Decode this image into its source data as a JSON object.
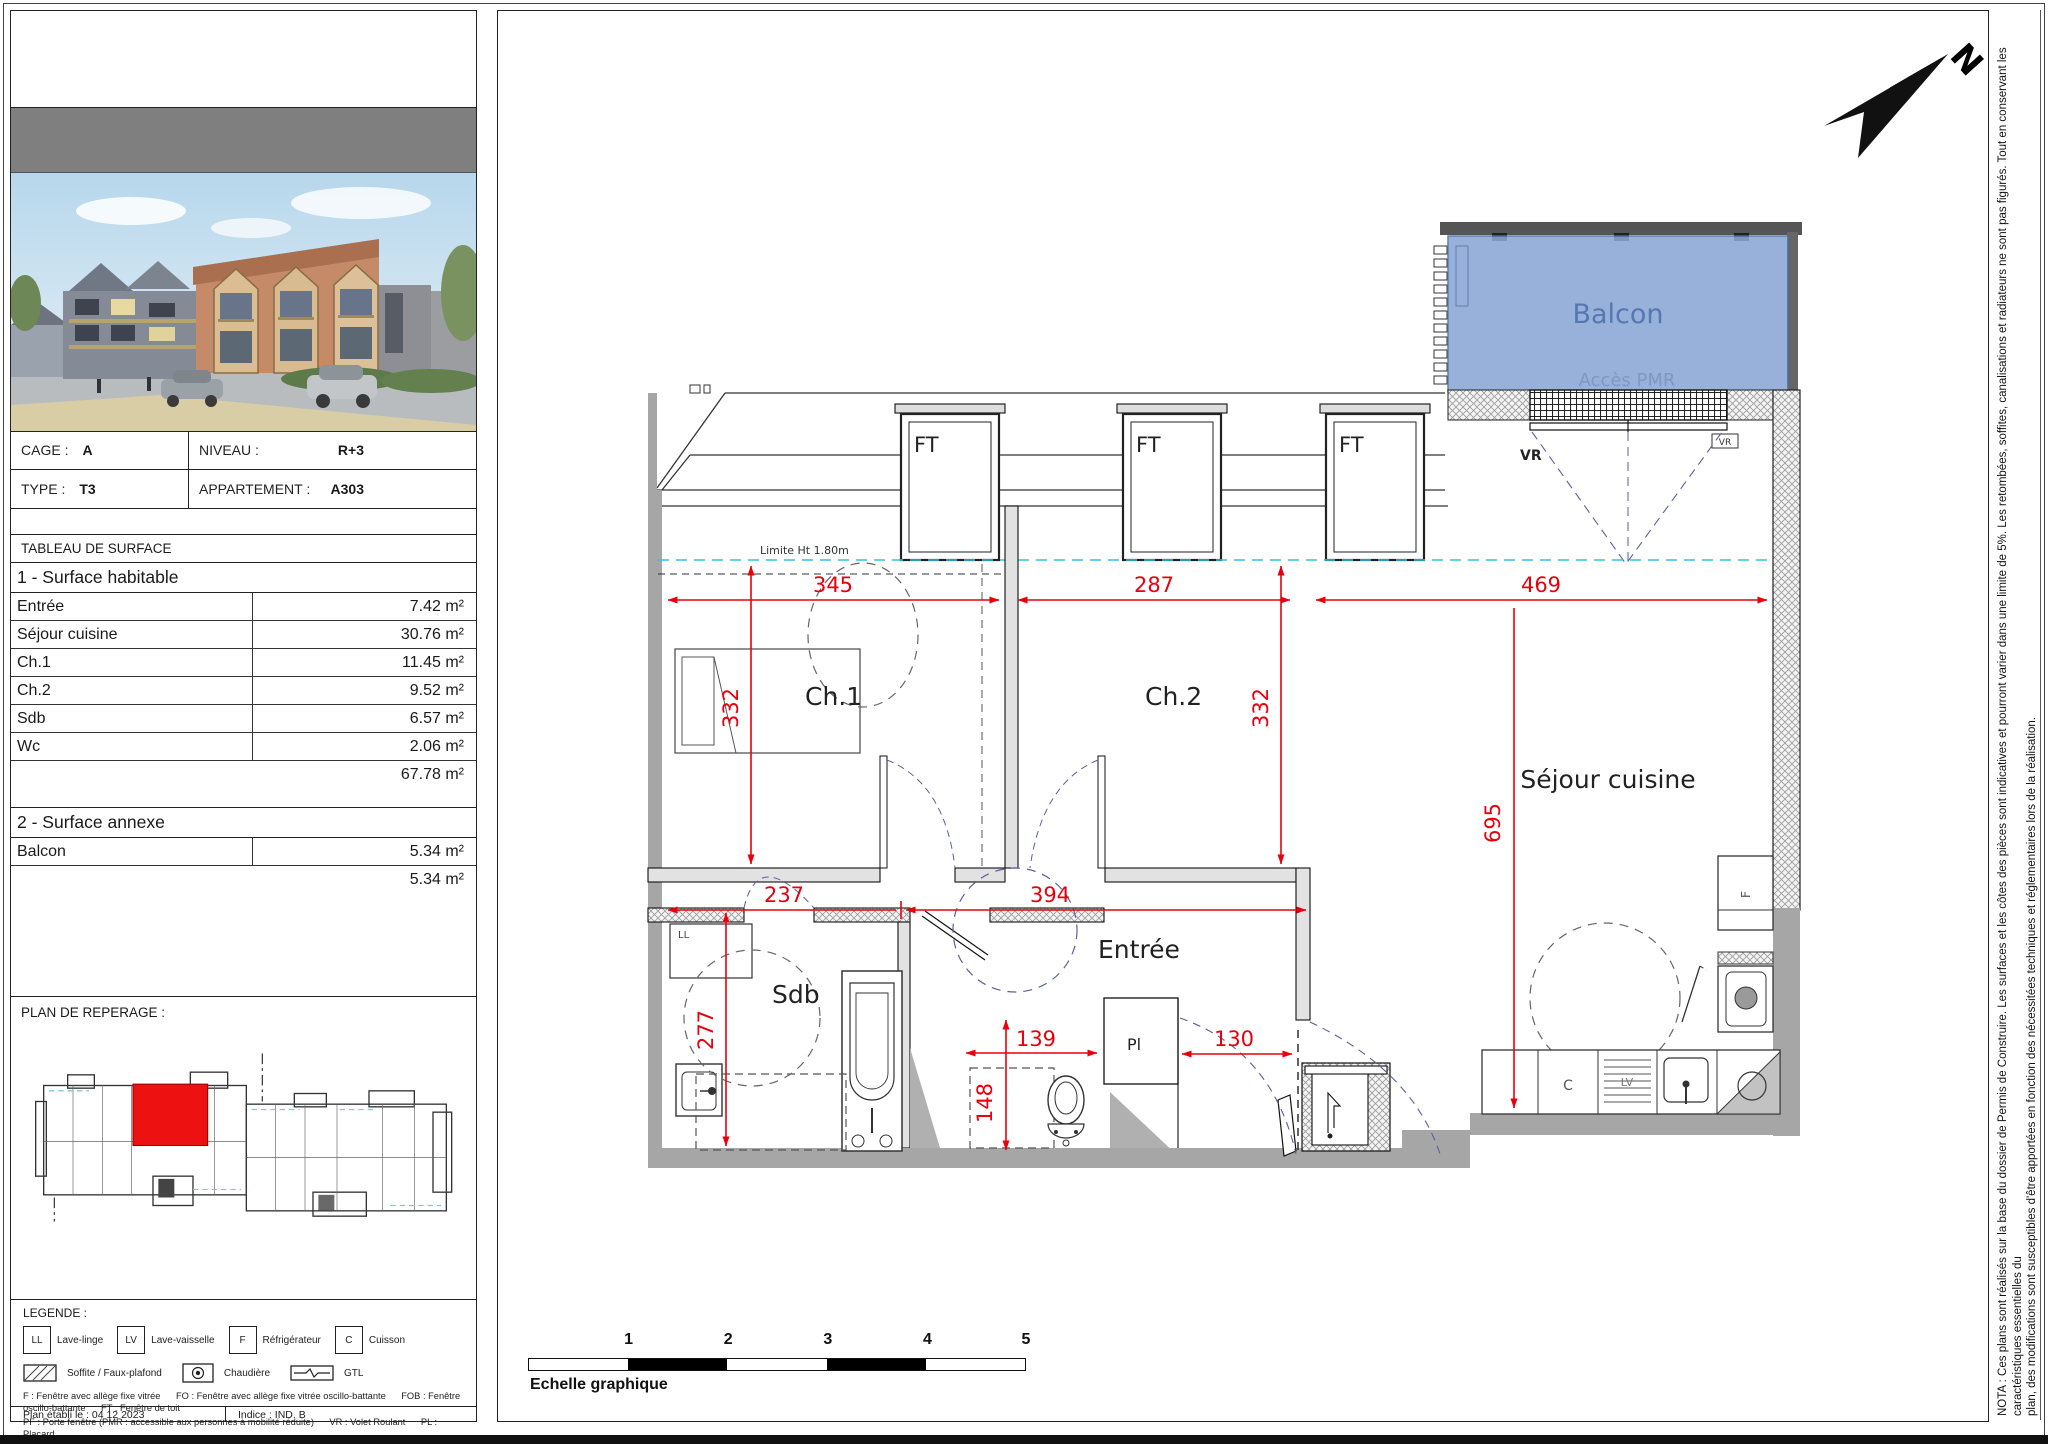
{
  "sidebar": {
    "info": {
      "cage_label": "CAGE :",
      "cage_value": "A",
      "niveau_label": "NIVEAU :",
      "niveau_value": "R+3",
      "type_label": "TYPE :",
      "type_value": "T3",
      "appartement_label": "APPARTEMENT :",
      "appartement_value": "A303"
    },
    "surface_table": {
      "title": "TABLEAU DE SURFACE",
      "section1": "1 - Surface habitable",
      "rows": [
        {
          "label": "Entrée",
          "value": "7.42 m²"
        },
        {
          "label": "Séjour cuisine",
          "value": "30.76 m²"
        },
        {
          "label": "Ch.1",
          "value": "11.45 m²"
        },
        {
          "label": "Ch.2",
          "value": "9.52 m²"
        },
        {
          "label": "Sdb",
          "value": "6.57 m²"
        },
        {
          "label": "Wc",
          "value": "2.06 m²"
        }
      ],
      "section1_total": "67.78 m²",
      "section2": "2 - Surface annexe",
      "annexe_rows": [
        {
          "label": "Balcon",
          "value": "5.34 m²"
        }
      ],
      "section2_total": "5.34 m²"
    },
    "reperage_title": "PLAN DE REPERAGE :",
    "legend": {
      "title": "LEGENDE :",
      "appliances": [
        {
          "code": "LL",
          "label": "Lave-linge"
        },
        {
          "code": "LV",
          "label": "Lave-vaisselle"
        },
        {
          "code": "F",
          "label": "Réfrigérateur"
        },
        {
          "code": "C",
          "label": "Cuisson"
        }
      ],
      "symbols": [
        {
          "label": "Soffite / Faux-plafond"
        },
        {
          "label": "Chaudière"
        },
        {
          "label": "GTL"
        }
      ],
      "abbrev_line1": "F : Fenêtre avec allège fixe vitrée      FO : Fenêtre avec allège fixe vitrée oscillo-battante      FOB : Fenêtre oscillo-battante      FT : Fenêtre de toit",
      "abbrev_line2": "PF : Porte fenêtre (PMR : accessible aux personnes à mobilité réduite)      VR : Volet Roulant      PL : Placard",
      "footer_left": "Plan établi le : 04 12 2023",
      "footer_right": "Indice : IND. B"
    }
  },
  "plan": {
    "north_label": "N",
    "balcon": "Balcon",
    "acces_pmr": "Accès PMR",
    "limite": "Limite Ht 1.80m",
    "rooms": {
      "ch1": "Ch.1",
      "ch2": "Ch.2",
      "sejour": "Séjour cuisine",
      "sdb": "Sdb",
      "entree": "Entrée"
    },
    "labels": {
      "ft": "FT",
      "vr": "VR",
      "ll": "LL",
      "c": "C",
      "lv": "LV",
      "f": "F",
      "pl": "Pl"
    },
    "dims": {
      "ch1_w": "345",
      "ch2_w": "287",
      "sejour_w": "469",
      "ch1_h": "332",
      "ch2_h": "332",
      "sejour_h": "695",
      "sdb_w": "237",
      "hall_w": "394",
      "sdb_h": "277",
      "wc_w": "139",
      "wc_h": "148",
      "entree_w": "130"
    }
  },
  "scale_bar": {
    "numbers": [
      "1",
      "2",
      "3",
      "4",
      "5"
    ],
    "label": "Echelle graphique"
  },
  "nota": {
    "line1": "NOTA : Ces plans sont réalisés sur la base du dossier de Permis de Construire. Les surfaces et les côtes des pièces sont indicatives et pourront varier dans une limite de 5%.  Les retombées, soffites, canalisations et radiateurs ne sont pas figurés. Tout en conservant les caractéristiques essentielles du",
    "line2": "plan, des modifications sont susceptibles d'être apportées en fonction des nécessitées techniques et réglementaires lors de la réalisation."
  },
  "colors": {
    "dimension_red": "#e8000d",
    "balcony_blue": "#89a7d6",
    "limit_cyan": "#2fc4dc",
    "highlight_red": "#ee1111",
    "wall_gray": "#a6a6a6"
  }
}
